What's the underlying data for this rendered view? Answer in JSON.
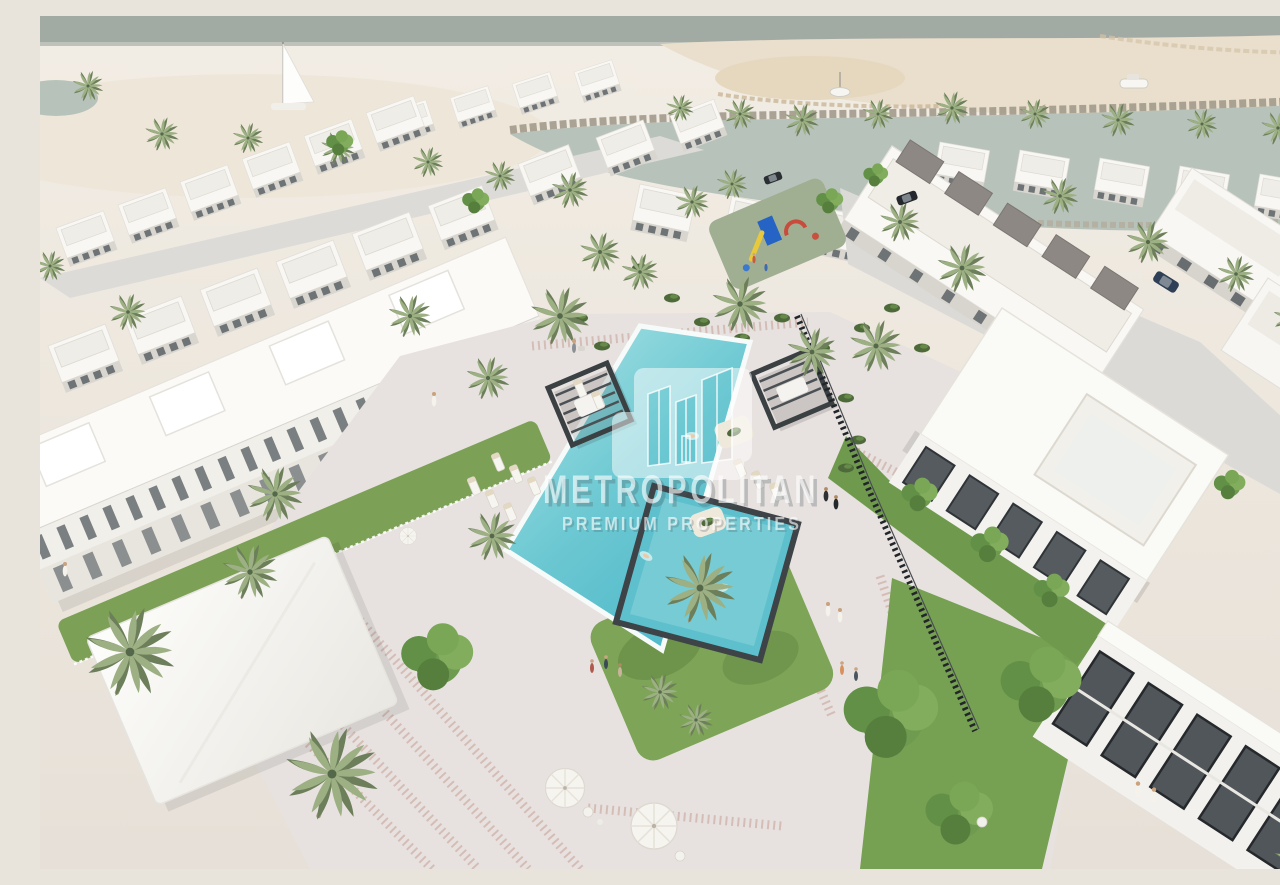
{
  "meta": {
    "description": "Aerial 3D architectural rendering of a white beachfront villa community with a central swimming-pool plaza, palm landscaping and a boat canal",
    "style": "architectural visualization"
  },
  "watermark": {
    "title": "METROPOLITAN",
    "subtitle": "PREMIUM PROPERTIES",
    "logo": "three-towers-logo"
  },
  "colors": {
    "sea": "#a2aaa4",
    "sand": "#efe9df",
    "sandbar": "#e6d9c2",
    "canal": "#b7c3ba",
    "breakwater": "#a59e8f",
    "building_white": "#f8f7f3",
    "building_shadow": "#d9d6d0",
    "glass": "#60666a",
    "roof_taupe": "#8e8884",
    "pavement": "#e7e2df",
    "mosaic": "#c79f96",
    "street": "#dbdad6",
    "lawn": "#7da457",
    "tree_green": "#6f9b50",
    "palm_green": "#9db084",
    "palm_dark": "#6c7f5a",
    "shrub": "#4e6a3a",
    "pool_light": "#a8e2e4",
    "pool_deep": "#4fb9c9",
    "pool_rim": "#f6fbfa",
    "kids_pool_coping": "#3d4347",
    "cabana_frame": "#3b4043",
    "fence_dark": "#22262a",
    "umbrella": "#f6f4ef",
    "watermark_text": "#ffffff"
  },
  "scene": {
    "water_features": [
      "sea horizon",
      "boat canal",
      "main pool",
      "kids pool"
    ],
    "boats": [
      "sailboat",
      "catamaran",
      "motor yacht"
    ],
    "buildings": [
      "beachfront villa rows",
      "townhouse row",
      "right villa cluster",
      "corner villa"
    ],
    "amenities": [
      "pool cabanas",
      "sun loungers",
      "playground",
      "cafe umbrellas",
      "landscaped plaza"
    ],
    "cabana_count": 2,
    "landscape": [
      "date palms",
      "leafy trees",
      "lawn islands",
      "shrub beds",
      "mosaic walkways"
    ]
  }
}
